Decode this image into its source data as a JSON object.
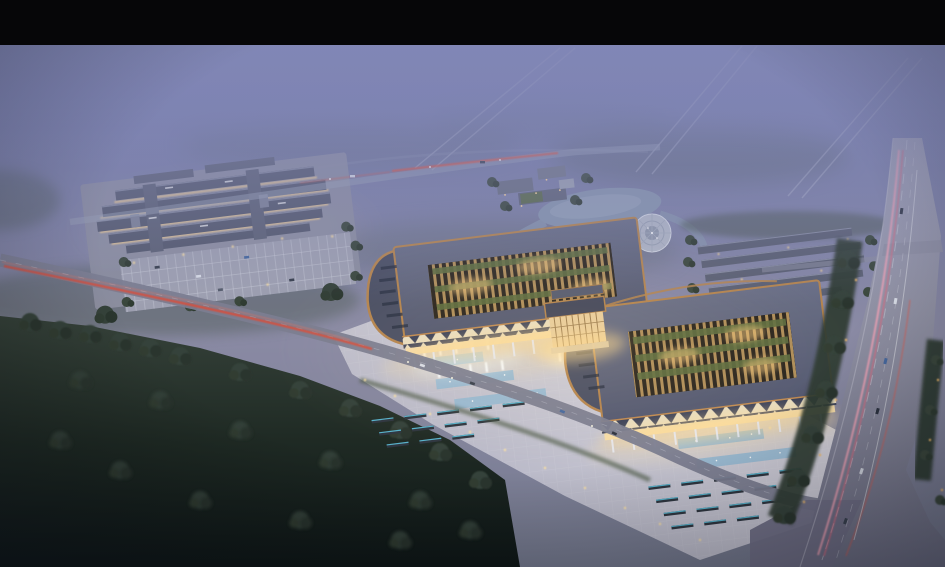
{
  "meta": {
    "kind": "architectural-aerial-rendering",
    "time_of_day": "dusk-with-fog",
    "no_visible_text": true
  },
  "scene": {
    "regions": {
      "letterbox": "black letterbox bar",
      "sky": "foggy purple dusk sky and distant landscape",
      "distant_roads": "faint distant highways in fog",
      "left_complex": "left building cluster with parking lot",
      "main_left_wing": "main hall left wing with courtyard roof",
      "main_right_wing": "main hall right wing with courtyard roof",
      "gate": "central gate pavilion",
      "plaza": "front plaza with fountains and hedges",
      "pond": "pond and circular fountain plaza",
      "rear_rows": "rear row buildings",
      "highway": "multi-lane highway with light trails",
      "front_road": "front access road with tail-light trail",
      "forest": "dark foreground forest"
    },
    "palette": {
      "letterbox": "#060608",
      "sky_top": "#6b74aa",
      "sky_mid": "#8a8aa4",
      "fog": "#8489b7",
      "roof_slate": "#5d6278",
      "roof_trim_copper": "#b5854f",
      "courtyard_wood": "#bb9760",
      "courtyard_green": "#5f6e41",
      "canopy_light": "#e8ddc2",
      "canopy_dark": "#3a415a",
      "facade_glow": "#ffd98e",
      "plaza_paving": "#c9c8d4",
      "pool_blue": "#8fb6d2",
      "hedge_glow": "#5fc8e4",
      "lamp_warm": "#f7dca0",
      "road_gray": "#7b7d90",
      "highway_gray": "#8c8da0",
      "taillight_red": "#d6503e",
      "lighttrail_pink": "#f2a2b6",
      "forest_dark": "#1a241e",
      "tree_green": "#35423a",
      "water": "#8795ad"
    }
  }
}
